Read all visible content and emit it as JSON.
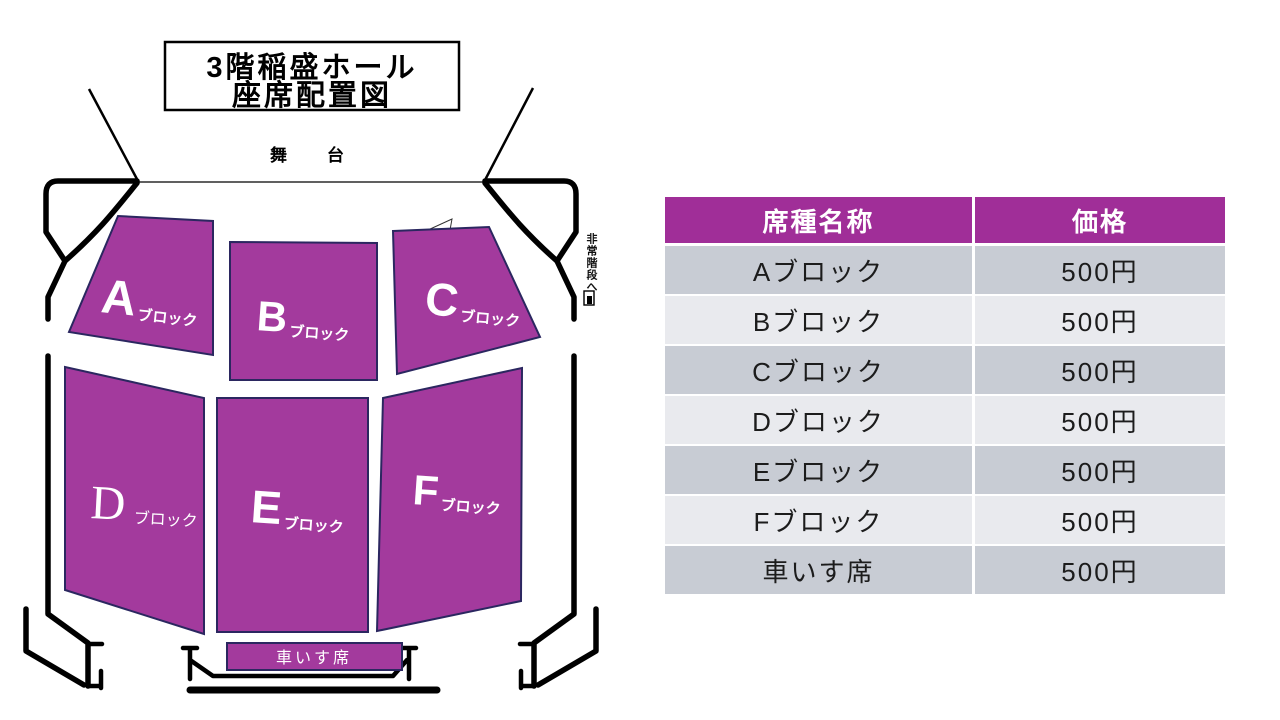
{
  "seat_map": {
    "title_line1": "3階稲盛ホール",
    "title_line2": "座席配置図",
    "stage_label": "舞台",
    "emergency_exit_label": "非常階段へ",
    "wheelchair_label": "車いす席",
    "blocks": [
      {
        "letter": "A",
        "suffix": "ブロック"
      },
      {
        "letter": "B",
        "suffix": "ブロック"
      },
      {
        "letter": "C",
        "suffix": "ブロック"
      },
      {
        "letter": "D",
        "suffix": "ブロック"
      },
      {
        "letter": "E",
        "suffix": "ブロック"
      },
      {
        "letter": "F",
        "suffix": "ブロック"
      }
    ],
    "colors": {
      "block_fill": "#A33A9D",
      "block_border": "#2B2760",
      "outline": "#000000"
    }
  },
  "price_table": {
    "headers": [
      "席種名称",
      "価格"
    ],
    "rows": [
      {
        "name": "Aブロック",
        "price": "500円"
      },
      {
        "name": "Bブロック",
        "price": "500円"
      },
      {
        "name": "Cブロック",
        "price": "500円"
      },
      {
        "name": "Dブロック",
        "price": "500円"
      },
      {
        "name": "Eブロック",
        "price": "500円"
      },
      {
        "name": "Fブロック",
        "price": "500円"
      },
      {
        "name": "車いす席",
        "price": "500円"
      }
    ],
    "colors": {
      "header_bg": "#A02E98",
      "header_text": "#FFFFFF",
      "row_dark": "#C8CCD4",
      "row_light": "#E9EAEE",
      "row_text": "#1C1C1C"
    }
  }
}
